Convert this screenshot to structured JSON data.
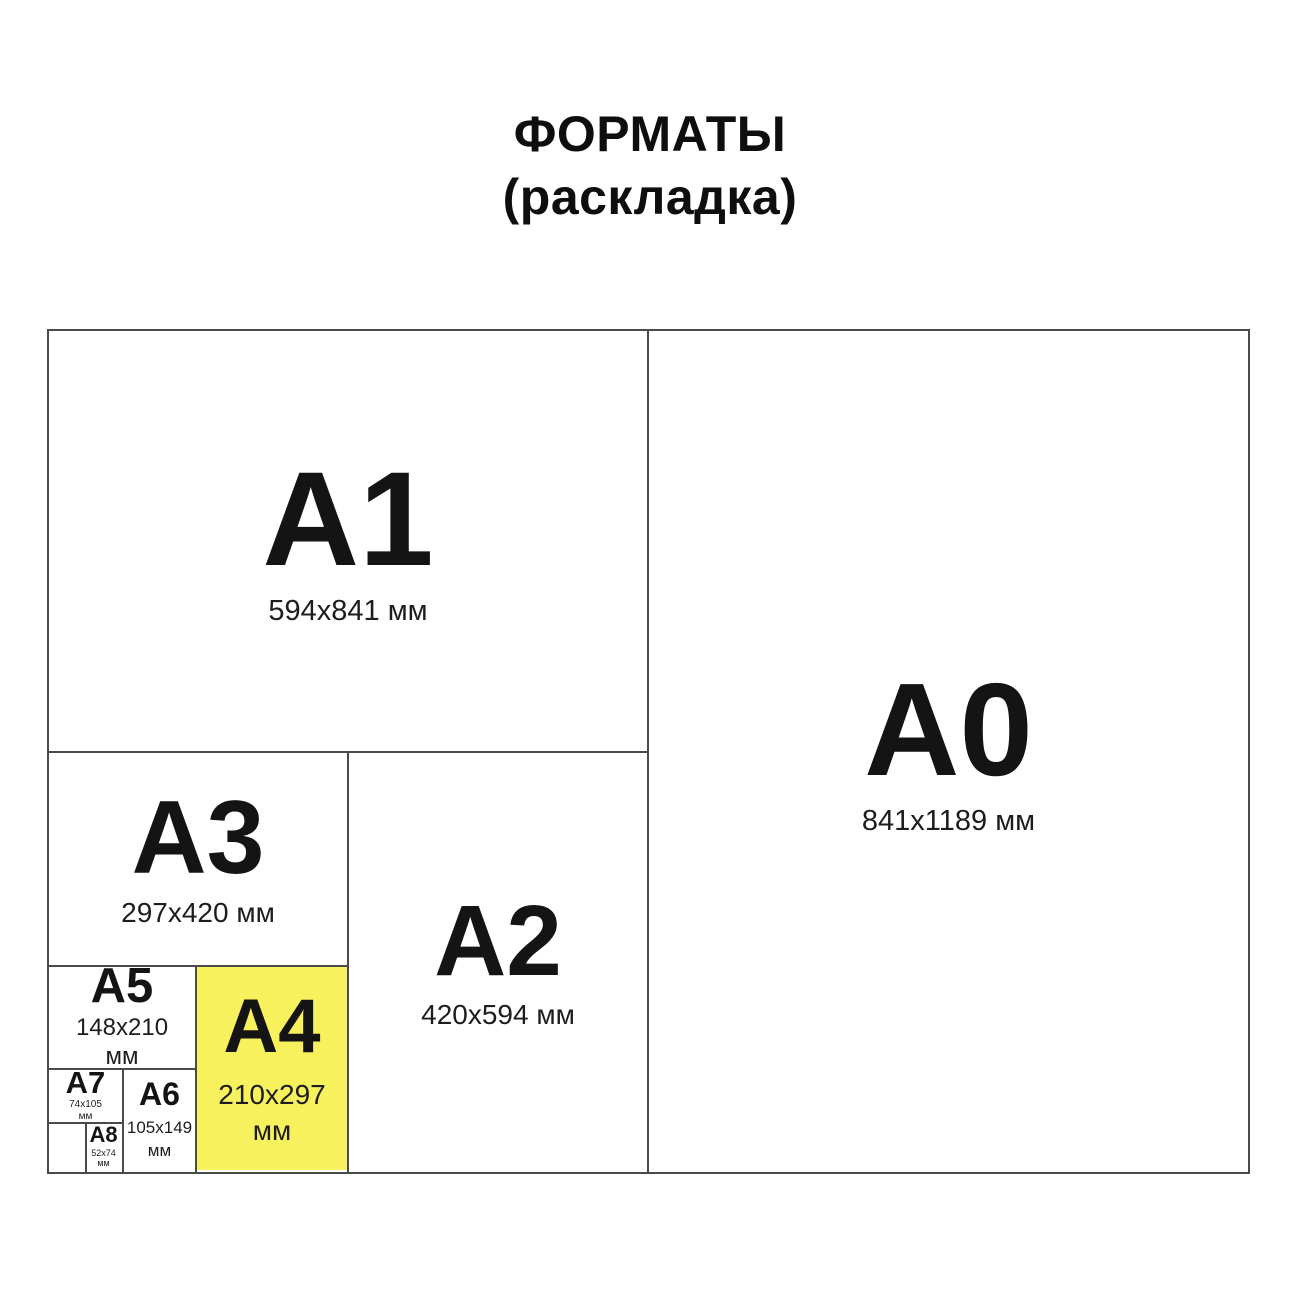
{
  "title": {
    "line1": "ФОРМАТЫ",
    "line2": "(раскладка)"
  },
  "colors": {
    "highlight_yellow": "#F8F15E",
    "divider_gray": "#4a4a4a",
    "text_black": "#141414"
  },
  "formats": [
    {
      "id": "a1",
      "label": "A1",
      "dimensions": [
        "594x841 мм"
      ],
      "highlighted": false
    },
    {
      "id": "a0",
      "label": "A0",
      "dimensions": [
        "841x1189 мм"
      ],
      "highlighted": false
    },
    {
      "id": "a3",
      "label": "A3",
      "dimensions": [
        "297x420 мм"
      ],
      "highlighted": false
    },
    {
      "id": "a2",
      "label": "A2",
      "dimensions": [
        "420x594 мм"
      ],
      "highlighted": false
    },
    {
      "id": "a5",
      "label": "A5",
      "dimensions": [
        "148x210",
        "мм"
      ],
      "highlighted": false
    },
    {
      "id": "a4",
      "label": "A4",
      "dimensions": [
        "210x297",
        "мм"
      ],
      "highlighted": true
    },
    {
      "id": "a7",
      "label": "A7",
      "dimensions": [
        "74x105",
        "мм"
      ],
      "highlighted": false
    },
    {
      "id": "a6",
      "label": "A6",
      "dimensions": [
        "105x149",
        "мм"
      ],
      "highlighted": false
    },
    {
      "id": "a8",
      "label": "A8",
      "dimensions": [
        "52x74",
        "мм"
      ],
      "highlighted": false
    }
  ]
}
